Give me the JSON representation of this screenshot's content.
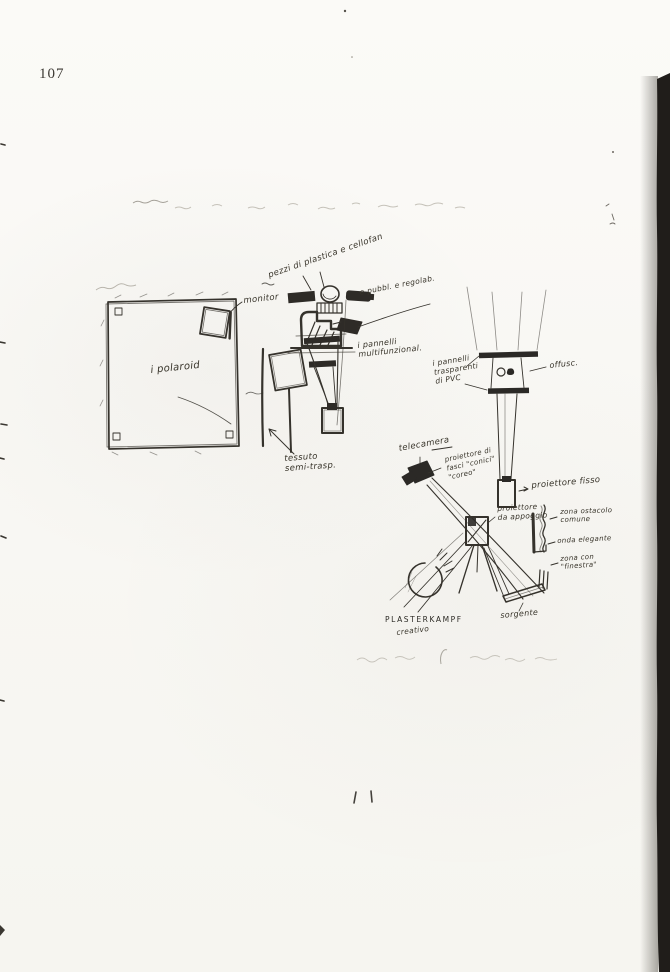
{
  "page": {
    "number": "107"
  },
  "diagram": {
    "labels": {
      "materials_note": "pezzi di plastica e cellofan",
      "audience_note": "e pubbl. e regolab.",
      "monitor": "monitor",
      "polaroid": "i polaroid",
      "multifunction_panels": "i pannelli\nmultifunzional.",
      "fabric": "tessuto\nsemi-trasp.",
      "camera": "telecamera",
      "cone_beams": "proiettore di\nfasci \"conici\"\n\"coreo\"",
      "fixed_projector": "proiettore fisso",
      "pvc_panels": "i pannelli\ntrasparenti\ndi PVC",
      "blur": "offusc.",
      "support_projector": "proiettore\nda appoggio",
      "zone_obstacle": "zona ostacolo\ncomune",
      "zone_wave": "onda elegante",
      "zone_window": "zona con\n\"finestra\"",
      "plasterkampf": "PLASTERKAMPF",
      "creativo": "creativo",
      "source": "sorgente"
    }
  }
}
